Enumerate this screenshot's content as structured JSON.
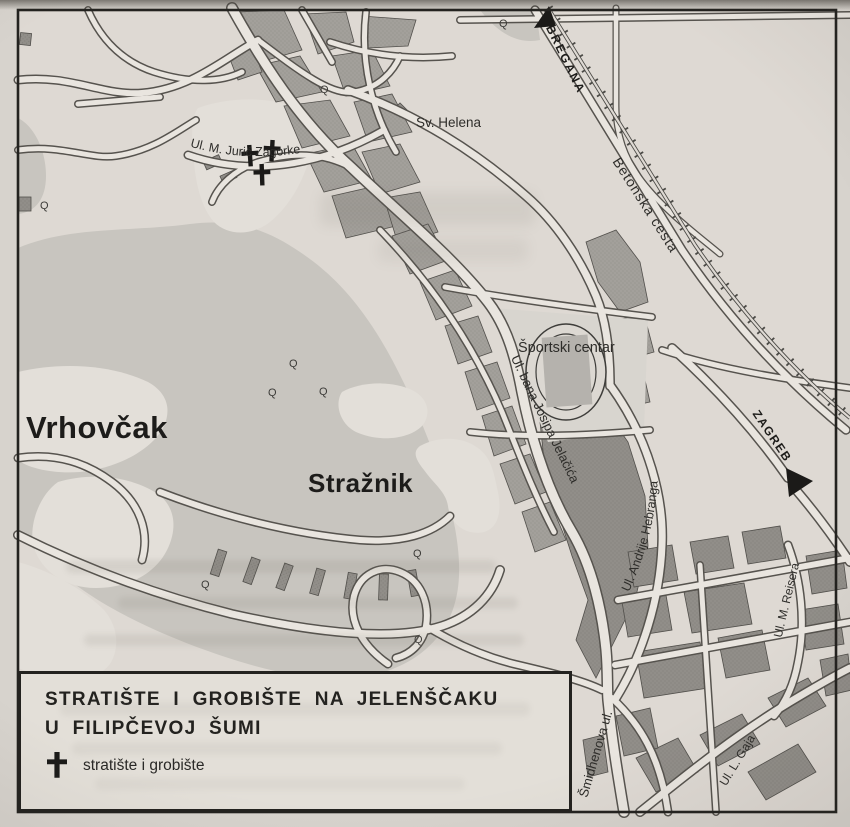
{
  "map": {
    "settlements": {
      "vrhovcak": "Vrhovčak",
      "straznik": "Stražnik",
      "sv_helena": "Sv. Helena",
      "sportski_centar": "Športski centar"
    },
    "streets": {
      "juric_zagorke": "Ul. M. Jurić Zagorke",
      "bana_josipa_jelacica": "Ul. bana Josipa Jelačića",
      "andrije_hebranga": "Ul. Andrije Hebranga",
      "betonska_cesta": "Betonska cesta",
      "smidhenova": "Šmidhenova ul.",
      "m_reisera": "Ul. M. Reisera",
      "l_gaja": "Ul. L. Gaja"
    },
    "directions": {
      "bregana": "BREGANA",
      "zagreb": "ZAGREB"
    },
    "symbols": {
      "tree_glyph": "Q"
    },
    "colors": {
      "paper": "#ded9d3",
      "forest": "#c8c5bf",
      "patch": "#e3dfd9",
      "road": "#e9e5df",
      "urban_block": "#a3a09b",
      "building_dark": "#918e89",
      "ink": "#23221f"
    }
  },
  "legend": {
    "title_line1": "STRATIŠTE I GROBIŠTE NA JELENŠČAKU",
    "title_line2": "U FILIPČEVOJ ŠUMI",
    "item_label": "stratište i grobište"
  }
}
